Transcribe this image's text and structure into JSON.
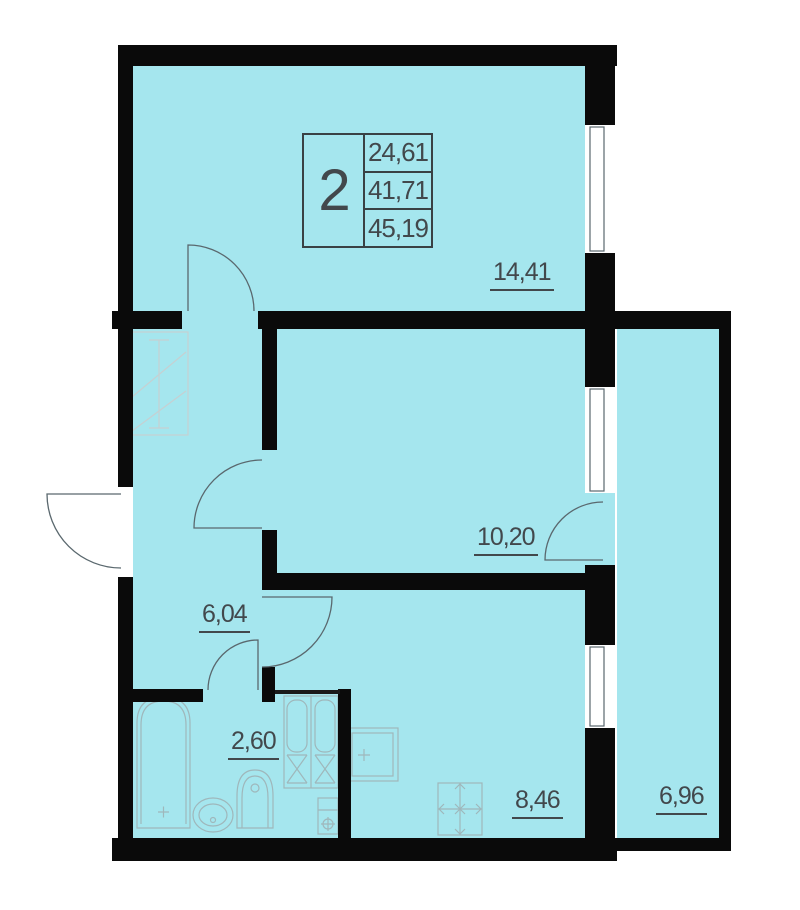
{
  "colors": {
    "room_fill": "#a5e6ee",
    "wall": "#0a0a0a",
    "outline": "#3a4144",
    "text": "#42484c",
    "door_line": "#5a686e",
    "furniture_line": "#9fb7bb",
    "faint_line": "#c6d0d2",
    "background": "#ffffff"
  },
  "info_box": {
    "number": "2",
    "values": [
      "24,61",
      "41,71",
      "45,19"
    ]
  },
  "rooms": [
    {
      "id": "living-room",
      "area": "14,41"
    },
    {
      "id": "bedroom",
      "area": "10,20"
    },
    {
      "id": "hallway",
      "area": "6,04"
    },
    {
      "id": "bathroom",
      "area": "2,60"
    },
    {
      "id": "kitchen",
      "area": "8,46"
    },
    {
      "id": "loggia",
      "area": "6,96"
    }
  ],
  "fixtures": [
    "wardrobe",
    "bathtub",
    "sink",
    "toilet",
    "vent-shaft",
    "kitchen-sink",
    "stove"
  ]
}
